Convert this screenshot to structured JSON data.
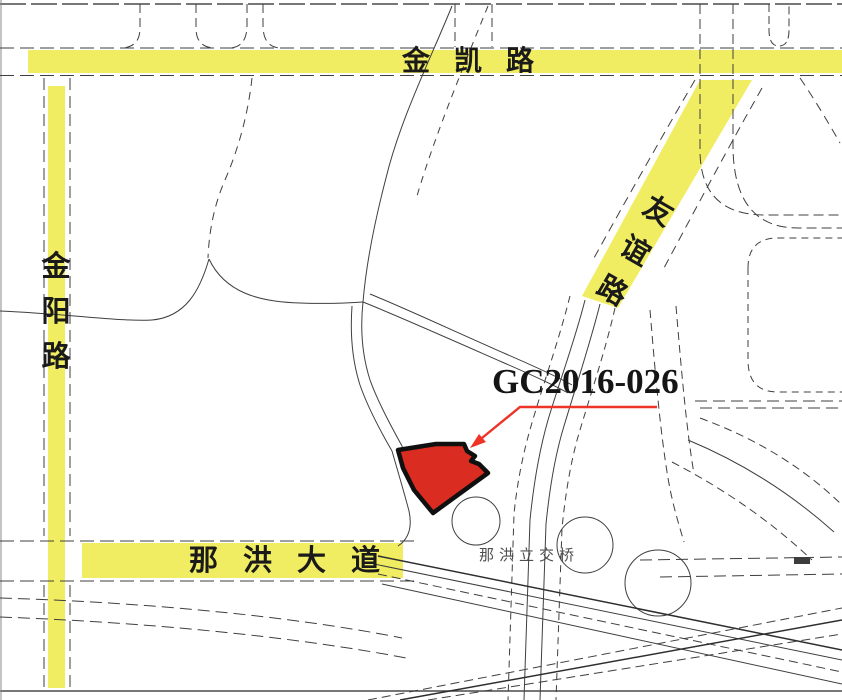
{
  "map": {
    "title_note": "parcel location map",
    "roads": {
      "jinkai": {
        "label": "金凯路"
      },
      "jinyang": {
        "chars": [
          "金",
          "阳",
          "路"
        ]
      },
      "youyi": {
        "chars": [
          "友",
          "谊",
          "路"
        ]
      },
      "nahong": {
        "label": "那洪大道"
      }
    },
    "parcel": {
      "code": "GC2016-026"
    },
    "interchange": {
      "label": "那洪立交桥"
    },
    "colors": {
      "road_highlight": "#f1ed62",
      "parcel_fill": "#da2c20",
      "parcel_outline": "#101010",
      "leader_red": "#ee3327",
      "line": "#3f3f3f"
    }
  }
}
